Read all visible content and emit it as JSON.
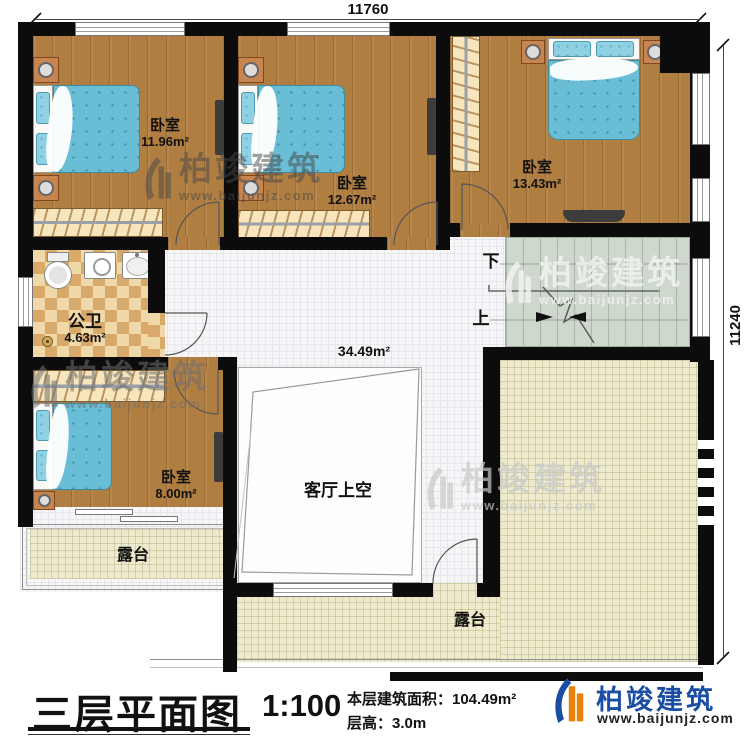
{
  "plan": {
    "dim_top": "11760",
    "dim_right": "11240",
    "rooms": {
      "bedroom1": {
        "name": "卧室",
        "area": "11.96m²"
      },
      "bedroom2": {
        "name": "卧室",
        "area": "12.67m²"
      },
      "bedroom3": {
        "name": "卧室",
        "area": "13.43m²"
      },
      "bedroom4": {
        "name": "卧室",
        "area": "8.00m²"
      },
      "bathroom": {
        "name": "公卫",
        "area": "4.63m²"
      },
      "hall_area": "34.49m²",
      "living_void": {
        "name": "客厅上空"
      },
      "terrace_left": {
        "name": "露台"
      },
      "terrace_right": {
        "name": "露台"
      }
    },
    "stairs": {
      "down_label": "下",
      "up_label": "上"
    }
  },
  "title_block": {
    "title": "三层平面图",
    "scale": "1:100",
    "floor_area_label": "本层建筑面积：104.49m²",
    "floor_height_label": "层高：3.0m"
  },
  "brand": {
    "name": "柏竣建筑",
    "website": "www.baijunjz.com"
  },
  "colors": {
    "wall": "#0c0c0c",
    "wood_floor": "#b17e41",
    "hall_tile": "#f6f6f8",
    "terrace_tile": "#edeacd",
    "bathroom_tile": "#f0d9a8",
    "stair_fill": "#ced8cd",
    "bed_blue": "#69bed6",
    "brand_blue": "#1a4ea3",
    "brand_orange": "#e8820c"
  }
}
